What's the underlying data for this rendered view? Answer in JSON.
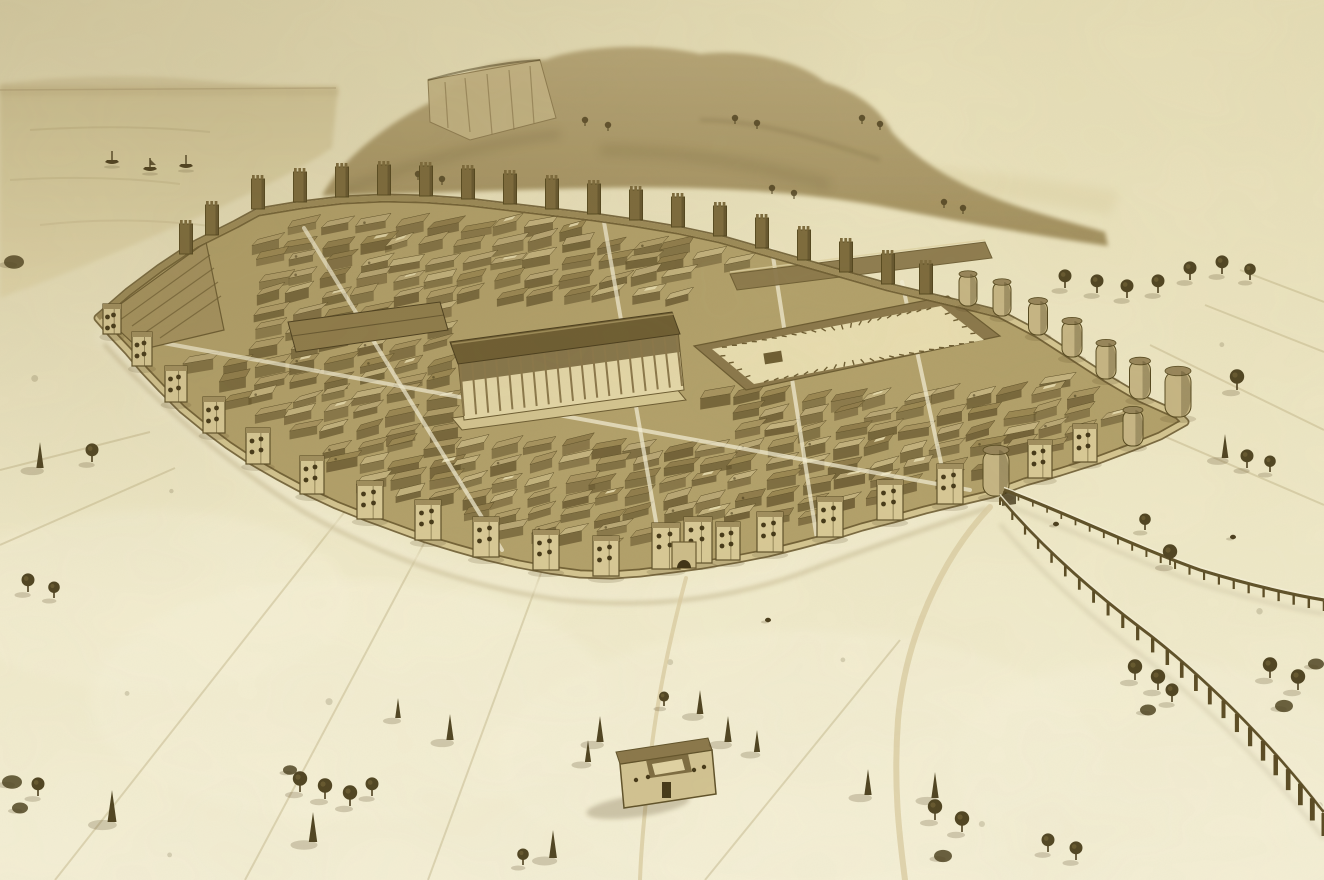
{
  "scene": {
    "title": "Aerial reconstruction drawing of a fortified ancient Roman city",
    "medium": "sepia ink and wash illustration",
    "palette": {
      "paper": "#eee7c4",
      "paper_light": "#f6f1d8",
      "paper_dark": "#e3d9ad",
      "sky_top": "#e5ddb6",
      "sea": "#dcd1a4",
      "horizon": "#b3a37a",
      "hill": "#b7a678",
      "hill_deep": "#a2905f",
      "cliff": "#c6b687",
      "ink": "#4a3d1d",
      "line": "#6b5b31",
      "wall_light": "#d4c591",
      "wall_shade": "#9c8a58",
      "city_base": "#b2a06a",
      "building_front": "#63532c",
      "roof_dark": "#6e5d32",
      "plaza": "#e8ddb0",
      "tree": "#4f4422",
      "road_light": "#d9cba0",
      "shadow": "rgba(88,72,38,0.45)"
    },
    "wall_polygon": [
      [
        98,
        318
      ],
      [
        128,
        292
      ],
      [
        160,
        268
      ],
      [
        196,
        244
      ],
      [
        236,
        224
      ],
      [
        258,
        212
      ],
      [
        300,
        205
      ],
      [
        342,
        200
      ],
      [
        384,
        198
      ],
      [
        426,
        199
      ],
      [
        468,
        202
      ],
      [
        510,
        207
      ],
      [
        552,
        212
      ],
      [
        594,
        217
      ],
      [
        636,
        223
      ],
      [
        678,
        230
      ],
      [
        720,
        239
      ],
      [
        762,
        251
      ],
      [
        804,
        263
      ],
      [
        846,
        275
      ],
      [
        888,
        287
      ],
      [
        930,
        297
      ],
      [
        968,
        306
      ],
      [
        1000,
        314
      ],
      [
        1038,
        334
      ],
      [
        1072,
        356
      ],
      [
        1106,
        378
      ],
      [
        1140,
        398
      ],
      [
        1178,
        415
      ],
      [
        1185,
        422
      ],
      [
        1160,
        436
      ],
      [
        1130,
        448
      ],
      [
        1098,
        460
      ],
      [
        1060,
        472
      ],
      [
        1025,
        482
      ],
      [
        992,
        494
      ],
      [
        958,
        502
      ],
      [
        925,
        510
      ],
      [
        893,
        519
      ],
      [
        862,
        527
      ],
      [
        830,
        537
      ],
      [
        800,
        545
      ],
      [
        768,
        553
      ],
      [
        737,
        559
      ],
      [
        702,
        565
      ],
      [
        672,
        569
      ],
      [
        640,
        573
      ],
      [
        612,
        575
      ],
      [
        580,
        574
      ],
      [
        550,
        570
      ],
      [
        518,
        564
      ],
      [
        488,
        557
      ],
      [
        456,
        548
      ],
      [
        426,
        539
      ],
      [
        396,
        528
      ],
      [
        366,
        517
      ],
      [
        336,
        505
      ],
      [
        306,
        491
      ],
      [
        278,
        476
      ],
      [
        252,
        461
      ],
      [
        228,
        445
      ],
      [
        204,
        427
      ],
      [
        182,
        409
      ],
      [
        162,
        389
      ],
      [
        144,
        370
      ],
      [
        128,
        351
      ],
      [
        112,
        334
      ]
    ],
    "towers": {
      "crenellated": [
        [
          258,
          211
        ],
        [
          300,
          204
        ],
        [
          342,
          199
        ],
        [
          384,
          197
        ],
        [
          426,
          198
        ],
        [
          468,
          201
        ],
        [
          510,
          206
        ],
        [
          552,
          211
        ],
        [
          594,
          216
        ],
        [
          636,
          222
        ],
        [
          678,
          229
        ],
        [
          720,
          238
        ],
        [
          762,
          250
        ],
        [
          804,
          262
        ],
        [
          846,
          274
        ],
        [
          888,
          286
        ],
        [
          926,
          296
        ],
        [
          212,
          237
        ],
        [
          186,
          256
        ]
      ],
      "round": [
        [
          968,
          306,
          18,
          32
        ],
        [
          1002,
          316,
          18,
          34
        ],
        [
          1038,
          335,
          19,
          34
        ],
        [
          1072,
          357,
          20,
          36
        ],
        [
          1106,
          379,
          20,
          36
        ],
        [
          1140,
          399,
          21,
          38
        ],
        [
          1178,
          417,
          26,
          46
        ],
        [
          1133,
          446,
          20,
          36
        ],
        [
          996,
          496,
          26,
          46
        ]
      ],
      "square_dot": [
        [
          1085,
          462,
          24,
          38
        ],
        [
          1040,
          478,
          24,
          38
        ],
        [
          950,
          504,
          26,
          40
        ],
        [
          890,
          520,
          26,
          40
        ],
        [
          830,
          537,
          26,
          40
        ],
        [
          770,
          552,
          26,
          40
        ],
        [
          728,
          560,
          24,
          38
        ],
        [
          698,
          563,
          28,
          46
        ],
        [
          666,
          569,
          28,
          46
        ],
        [
          606,
          576,
          26,
          40
        ],
        [
          546,
          570,
          26,
          40
        ],
        [
          486,
          557,
          26,
          40
        ],
        [
          428,
          540,
          26,
          40
        ],
        [
          370,
          519,
          26,
          38
        ],
        [
          312,
          494,
          24,
          38
        ],
        [
          258,
          464,
          24,
          36
        ],
        [
          214,
          433,
          22,
          36
        ],
        [
          176,
          402,
          22,
          36
        ],
        [
          142,
          366,
          20,
          34
        ],
        [
          112,
          334,
          18,
          30
        ]
      ]
    },
    "temple": {
      "colonnade_top": [
        [
          460,
          362
        ],
        [
          676,
          332
        ]
      ],
      "colonnade_bottom": [
        [
          464,
          416
        ],
        [
          682,
          386
        ]
      ],
      "columns": 18
    },
    "forum_inner_quad": [
      [
        712,
        349
      ],
      [
        941,
        306
      ],
      [
        984,
        340
      ],
      [
        754,
        384
      ]
    ],
    "streets": [
      [
        662,
        556,
        604,
        222
      ],
      [
        136,
        338,
        970,
        490
      ],
      [
        304,
        228,
        502,
        550
      ],
      [
        772,
        250,
        818,
        546
      ],
      [
        902,
        282,
        946,
        486
      ]
    ],
    "insulae": {
      "x0": 118,
      "x1": 1175,
      "y0": 212,
      "y1": 570,
      "dx": 34,
      "dy": 17,
      "shrink": 0.94,
      "colors": [
        "#b8a674",
        "#a6935f",
        "#c3b27e",
        "#9a8752",
        "#af9c68",
        "#8f7c4b"
      ],
      "exclude": [
        [
          430,
          302,
          270,
          140
        ],
        [
          686,
          276,
          326,
          118
        ],
        [
          86,
          238,
          150,
          116
        ],
        [
          640,
          535,
          100,
          45
        ]
      ]
    },
    "aqueducts": [
      {
        "path": "M1000,497 C1040,545 1090,590 1150,635 C1220,690 1280,755 1324,812",
        "piers": 24,
        "h1": 8,
        "h2": 24,
        "w1": 2,
        "w2": 5
      },
      {
        "path": "M1004,490 C1060,510 1130,545 1200,570 C1260,588 1300,596 1324,600",
        "piers": 22,
        "h1": 5,
        "h2": 11,
        "w1": 1.5,
        "w2": 2.5
      }
    ],
    "boats": [
      [
        112,
        162
      ],
      [
        150,
        169
      ],
      [
        186,
        166
      ]
    ],
    "hill_trees": [
      [
        585,
        122
      ],
      [
        608,
        127
      ],
      [
        735,
        120
      ],
      [
        757,
        125
      ],
      [
        862,
        120
      ],
      [
        880,
        126
      ],
      [
        772,
        190
      ],
      [
        794,
        195
      ],
      [
        944,
        204
      ],
      [
        963,
        210
      ],
      [
        418,
        176
      ],
      [
        442,
        181
      ]
    ],
    "trees": [
      {
        "t": "bush",
        "x": 14,
        "y": 262,
        "s": 10
      },
      {
        "t": "cyp",
        "x": 40,
        "y": 468,
        "s": 13
      },
      {
        "t": "round",
        "x": 92,
        "y": 462,
        "s": 9
      },
      {
        "t": "round",
        "x": 28,
        "y": 592,
        "s": 9
      },
      {
        "t": "round",
        "x": 54,
        "y": 598,
        "s": 8
      },
      {
        "t": "bush",
        "x": 12,
        "y": 782,
        "s": 10
      },
      {
        "t": "round",
        "x": 38,
        "y": 796,
        "s": 9
      },
      {
        "t": "bush",
        "x": 20,
        "y": 808,
        "s": 8
      },
      {
        "t": "cyp",
        "x": 112,
        "y": 822,
        "s": 16
      },
      {
        "t": "bush",
        "x": 290,
        "y": 770,
        "s": 7
      },
      {
        "t": "round",
        "x": 300,
        "y": 792,
        "s": 10
      },
      {
        "t": "round",
        "x": 325,
        "y": 799,
        "s": 10
      },
      {
        "t": "round",
        "x": 350,
        "y": 806,
        "s": 10
      },
      {
        "t": "round",
        "x": 372,
        "y": 796,
        "s": 9
      },
      {
        "t": "cyp",
        "x": 313,
        "y": 842,
        "s": 15
      },
      {
        "t": "cyp",
        "x": 450,
        "y": 740,
        "s": 13
      },
      {
        "t": "cyp",
        "x": 398,
        "y": 718,
        "s": 10
      },
      {
        "t": "cyp",
        "x": 553,
        "y": 858,
        "s": 14
      },
      {
        "t": "round",
        "x": 523,
        "y": 865,
        "s": 8
      },
      {
        "t": "cyp",
        "x": 600,
        "y": 742,
        "s": 13
      },
      {
        "t": "cyp",
        "x": 588,
        "y": 762,
        "s": 11
      },
      {
        "t": "cyp",
        "x": 700,
        "y": 714,
        "s": 12
      },
      {
        "t": "cyp",
        "x": 728,
        "y": 742,
        "s": 13
      },
      {
        "t": "cyp",
        "x": 757,
        "y": 752,
        "s": 11
      },
      {
        "t": "round",
        "x": 664,
        "y": 706,
        "s": 7
      },
      {
        "t": "round",
        "x": 1065,
        "y": 288,
        "s": 9
      },
      {
        "t": "round",
        "x": 1097,
        "y": 293,
        "s": 9
      },
      {
        "t": "round",
        "x": 1127,
        "y": 298,
        "s": 9
      },
      {
        "t": "round",
        "x": 1158,
        "y": 293,
        "s": 9
      },
      {
        "t": "round",
        "x": 1190,
        "y": 280,
        "s": 9
      },
      {
        "t": "round",
        "x": 1222,
        "y": 274,
        "s": 9
      },
      {
        "t": "round",
        "x": 1250,
        "y": 280,
        "s": 8
      },
      {
        "t": "round",
        "x": 1237,
        "y": 390,
        "s": 10
      },
      {
        "t": "cyp",
        "x": 1225,
        "y": 458,
        "s": 12
      },
      {
        "t": "round",
        "x": 1247,
        "y": 468,
        "s": 9
      },
      {
        "t": "round",
        "x": 1270,
        "y": 472,
        "s": 8
      },
      {
        "t": "round",
        "x": 1170,
        "y": 565,
        "s": 10
      },
      {
        "t": "round",
        "x": 1145,
        "y": 530,
        "s": 8
      },
      {
        "t": "round",
        "x": 1135,
        "y": 680,
        "s": 10
      },
      {
        "t": "round",
        "x": 1158,
        "y": 690,
        "s": 10
      },
      {
        "t": "round",
        "x": 1172,
        "y": 702,
        "s": 9
      },
      {
        "t": "bush",
        "x": 1148,
        "y": 710,
        "s": 8
      },
      {
        "t": "round",
        "x": 1270,
        "y": 678,
        "s": 10
      },
      {
        "t": "round",
        "x": 1298,
        "y": 690,
        "s": 10
      },
      {
        "t": "bush",
        "x": 1284,
        "y": 706,
        "s": 9
      },
      {
        "t": "bush",
        "x": 1316,
        "y": 664,
        "s": 8
      },
      {
        "t": "cyp",
        "x": 935,
        "y": 798,
        "s": 13
      },
      {
        "t": "round",
        "x": 935,
        "y": 820,
        "s": 10
      },
      {
        "t": "round",
        "x": 962,
        "y": 832,
        "s": 10
      },
      {
        "t": "bush",
        "x": 943,
        "y": 856,
        "s": 9
      },
      {
        "t": "round",
        "x": 1048,
        "y": 852,
        "s": 9
      },
      {
        "t": "round",
        "x": 1076,
        "y": 860,
        "s": 9
      },
      {
        "t": "cyp",
        "x": 868,
        "y": 795,
        "s": 13
      }
    ],
    "field_lines": [
      [
        175,
        468,
        0,
        545
      ],
      [
        350,
        505,
        55,
        880
      ],
      [
        430,
        532,
        245,
        880
      ],
      [
        150,
        432,
        0,
        470
      ],
      [
        545,
        562,
        428,
        880
      ],
      [
        1205,
        305,
        1324,
        352
      ],
      [
        1150,
        345,
        1324,
        430
      ],
      [
        1240,
        270,
        1324,
        302
      ],
      [
        1080,
        400,
        1324,
        505
      ],
      [
        900,
        640,
        705,
        880
      ]
    ],
    "figures": [
      [
        1233,
        537
      ],
      [
        1056,
        524
      ],
      [
        768,
        620
      ]
    ],
    "shrub_zones": [
      [
        20,
        340,
        220,
        160
      ],
      [
        40,
        560,
        260,
        300
      ],
      [
        300,
        620,
        380,
        240
      ],
      [
        760,
        640,
        240,
        220
      ],
      [
        1040,
        330,
        280,
        200
      ],
      [
        1150,
        560,
        170,
        300
      ]
    ],
    "counts": {
      "wall_towers": 48,
      "boats": 3,
      "aqueduct_lines": 2
    }
  }
}
